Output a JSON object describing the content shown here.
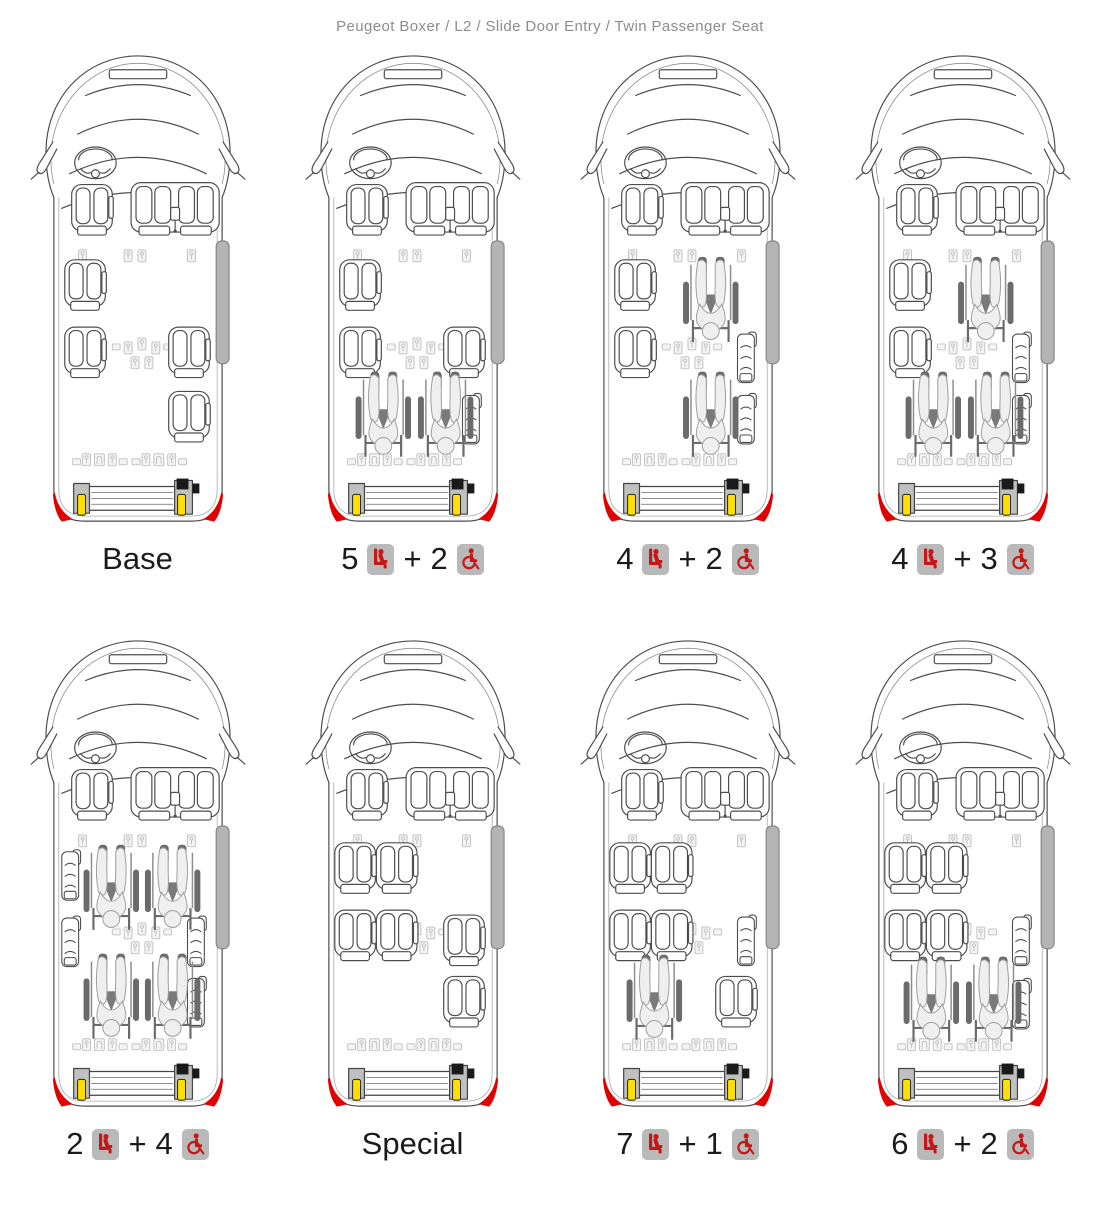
{
  "title": "Peugeot Boxer / L2 / Slide Door Entry / Twin Passenger Seat",
  "icons": {
    "seat": "seat-icon",
    "wheelchair": "wheelchair-icon"
  },
  "colors": {
    "title_gray": "#8c8c8c",
    "label_black": "#1b1b1b",
    "icon_box_gray": "#b9b9b9",
    "pictogram_red": "#c41818",
    "door_bar_gray": "#b4b4b4",
    "lift_handle_yellow": "#ffdf00",
    "corner_reflector_red": "#e10000"
  },
  "vans": [
    {
      "name": "base",
      "label": {
        "text": "Base"
      },
      "layout": {
        "passenger_seats": [
          [
            36,
            215
          ],
          [
            36,
            283
          ],
          [
            141,
            283
          ],
          [
            141,
            348
          ]
        ],
        "wheelchairs": [],
        "folded_seats": []
      }
    },
    {
      "name": "5-seats-2-wheelchairs",
      "label": {
        "seats": "5",
        "plus": "+",
        "wheelchairs": "2"
      },
      "layout": {
        "passenger_seats": [
          [
            36,
            215
          ],
          [
            36,
            283
          ],
          [
            141,
            283
          ]
        ],
        "wheelchairs": [
          [
            52,
            328
          ],
          [
            115,
            328
          ]
        ],
        "folded_seats": [
          [
            160,
            350
          ]
        ]
      }
    },
    {
      "name": "4-seats-2-wheelchairs",
      "label": {
        "seats": "4",
        "plus": "+",
        "wheelchairs": "2"
      },
      "layout": {
        "passenger_seats": [
          [
            36,
            215
          ],
          [
            36,
            283
          ]
        ],
        "wheelchairs": [
          [
            105,
            212
          ],
          [
            105,
            328
          ]
        ],
        "folded_seats": [
          [
            160,
            288
          ],
          [
            160,
            350
          ]
        ]
      }
    },
    {
      "name": "4-seats-3-wheelchairs",
      "label": {
        "seats": "4",
        "plus": "+",
        "wheelchairs": "3"
      },
      "layout": {
        "passenger_seats": [
          [
            36,
            215
          ],
          [
            36,
            283
          ]
        ],
        "wheelchairs": [
          [
            105,
            212
          ],
          [
            52,
            328
          ],
          [
            115,
            328
          ]
        ],
        "folded_seats": [
          [
            160,
            288
          ],
          [
            160,
            350
          ]
        ]
      }
    },
    {
      "name": "2-seats-4-wheelchairs",
      "label": {
        "seats": "2",
        "plus": "+",
        "wheelchairs": "4"
      },
      "layout": {
        "passenger_seats": [],
        "wheelchairs": [
          [
            55,
            215
          ],
          [
            117,
            215
          ],
          [
            55,
            325
          ],
          [
            117,
            325
          ]
        ],
        "folded_seats": [
          [
            33,
            220
          ],
          [
            33,
            287
          ],
          [
            160,
            287
          ],
          [
            160,
            348
          ]
        ]
      }
    },
    {
      "name": "special",
      "label": {
        "text": "Special"
      },
      "layout": {
        "passenger_seats": [
          [
            31,
            213
          ],
          [
            73,
            213
          ],
          [
            31,
            281
          ],
          [
            73,
            281
          ],
          [
            141,
            286
          ],
          [
            141,
            348
          ]
        ],
        "wheelchairs": [],
        "folded_seats": []
      }
    },
    {
      "name": "7-seats-1-wheelchair",
      "label": {
        "seats": "7",
        "plus": "+",
        "wheelchairs": "1"
      },
      "layout": {
        "passenger_seats": [
          [
            31,
            213
          ],
          [
            73,
            213
          ],
          [
            31,
            281
          ],
          [
            73,
            281
          ],
          [
            138,
            348
          ]
        ],
        "wheelchairs": [
          [
            48,
            326
          ]
        ],
        "folded_seats": [
          [
            160,
            286
          ]
        ]
      }
    },
    {
      "name": "6-seats-2-wheelchairs",
      "label": {
        "seats": "6",
        "plus": "+",
        "wheelchairs": "2"
      },
      "layout": {
        "passenger_seats": [
          [
            31,
            213
          ],
          [
            73,
            213
          ],
          [
            31,
            281
          ],
          [
            73,
            281
          ]
        ],
        "wheelchairs": [
          [
            50,
            328
          ],
          [
            113,
            328
          ]
        ],
        "folded_seats": [
          [
            160,
            286
          ],
          [
            160,
            350
          ]
        ]
      }
    }
  ]
}
